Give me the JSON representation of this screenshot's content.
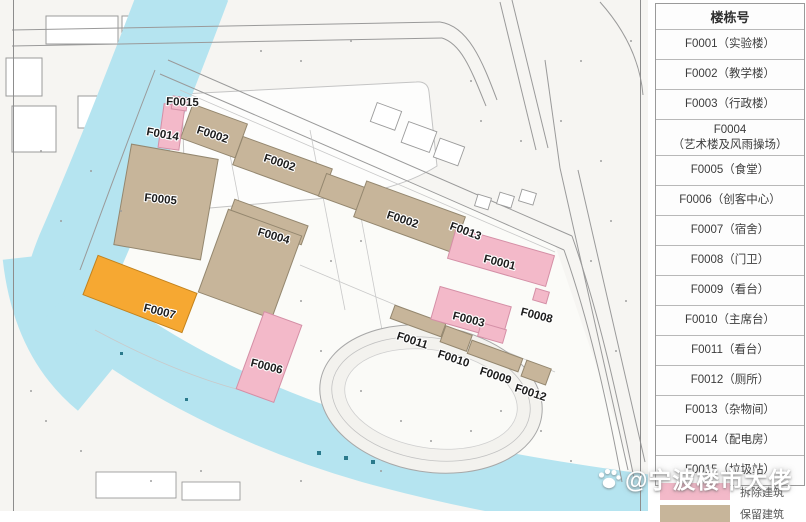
{
  "legend_table": {
    "header": "楼栋号",
    "rows": [
      "F0001（实验楼）",
      "F0002（教学楼）",
      "F0003（行政楼）",
      "F0004\n（艺术楼及风雨操场）",
      "F0005（食堂）",
      "F0006（创客中心）",
      "F0007（宿舍）",
      "F0008（门卫）",
      "F0009（看台）",
      "F0010（主席台）",
      "F0011（看台）",
      "F0012（厕所）",
      "F0013（杂物间）",
      "F0014（配电房）",
      "F0015（垃圾站）"
    ]
  },
  "legend": {
    "demolished": "拆除建筑",
    "retained": "保留建筑"
  },
  "colors": {
    "demolished": "#f3b9c9",
    "demolished_stroke": "#d48fa6",
    "retained": "#c7b59a",
    "retained_stroke": "#94876f",
    "highlight": "#f6a832",
    "highlight_stroke": "#c2821c",
    "river": "#b5e4f0"
  },
  "watermark": {
    "icon": "paw-icon",
    "text": "@宁波楼市大佬"
  },
  "map": {
    "labels": {
      "f0015": "F0015",
      "f0014": "F0014",
      "f0002a": "F0002",
      "f0002b": "F0002",
      "f0005": "F0005",
      "f0002c": "F0002",
      "f0013": "F0013",
      "f0004": "F0004",
      "f0001": "F0001",
      "f0003": "F0003",
      "f0008": "F0008",
      "f0007": "F0007",
      "f0011": "F0011",
      "f0010": "F0010",
      "f0006": "F0006",
      "f0009": "F0009",
      "f0012": "F0012"
    }
  }
}
